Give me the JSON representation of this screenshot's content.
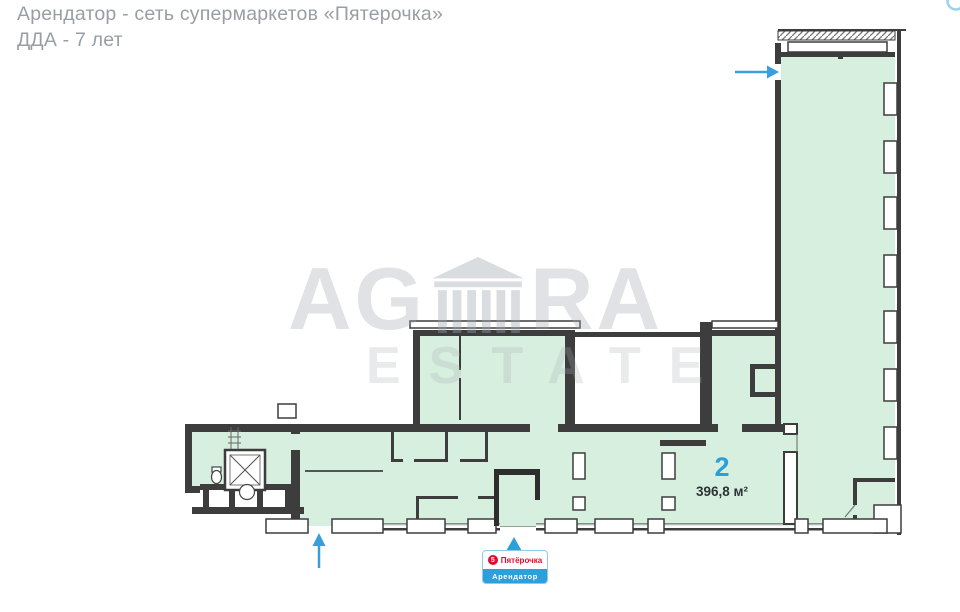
{
  "header": {
    "line1": "Арендатор - сеть супермаркетов «Пятерочка»",
    "line2": "ДДА - 7 лет"
  },
  "watermark": {
    "brand_left": "AG",
    "brand_right": "RA",
    "subtitle": "ESTATE"
  },
  "plan": {
    "unit": {
      "number": "2",
      "area": "396,8 м²"
    },
    "colors": {
      "leased_fill": "#d7efdf",
      "wall": "#3d3d3d",
      "entrance_arrow": "#3a9edb"
    }
  },
  "tenant_badge": {
    "badge": "5",
    "brand": "Пятёрочка",
    "label": "Арендатор",
    "brand_color": "#e30b2d",
    "bar_color": "#2e9fd9"
  }
}
